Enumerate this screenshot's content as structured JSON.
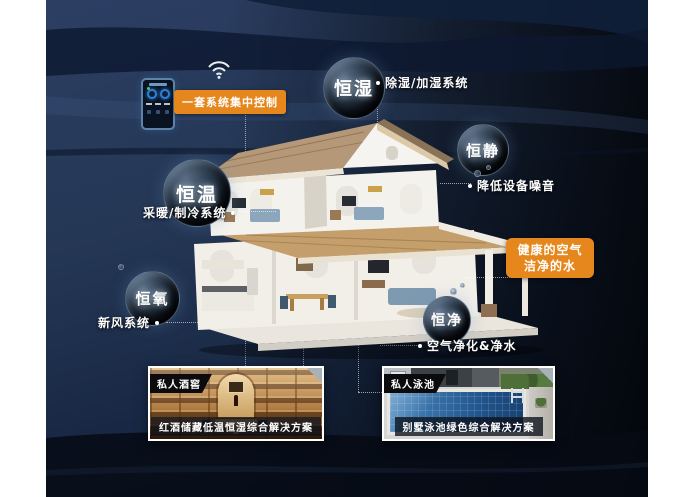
{
  "poster": {
    "control": {
      "badge": "一套系统集中控制"
    },
    "bubbles": {
      "humidity": {
        "label": "恒湿",
        "system": "除湿/加湿系统"
      },
      "quiet": {
        "label": "恒静",
        "system": "降低设备噪音"
      },
      "temperature": {
        "label": "恒温",
        "system": "采暖/制冷系统"
      },
      "oxygen": {
        "label": "恒氧",
        "system": "新风系统"
      },
      "purity": {
        "label": "恒净",
        "system": "空气净化&净水"
      }
    },
    "highlight": {
      "line1": "健康的空气",
      "line2": "洁净的水"
    },
    "insets": {
      "wine": {
        "tag": "私人酒窖",
        "caption": "红酒储藏低温恒湿综合解决方案"
      },
      "pool": {
        "tag": "私人泳池",
        "caption": "别墅泳池绿色综合解决方案"
      }
    },
    "colors": {
      "accent_orange": "#e5871c",
      "background_navy": "#243755",
      "background_dark": "#05080f",
      "pool_blue": "#2a6299",
      "roof_tan": "#b59878",
      "floor_wood": "#c49f6b"
    }
  }
}
